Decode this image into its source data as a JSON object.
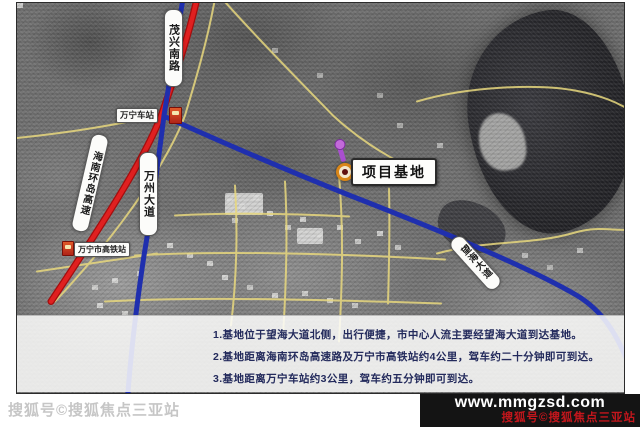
{
  "map": {
    "roads": {
      "maoxing_south_road": "茂兴南路",
      "hainan_ring_expressway": "海南环岛高速",
      "wanzhou_avenue": "万州大道",
      "wanghai_avenue": "望海大道"
    },
    "stations": {
      "wanning_railway_station": "万宁车站",
      "wanning_hsr_station": "万宁市高铁站"
    },
    "project_marker": {
      "label": "项目基地"
    },
    "info_box": {
      "line1": "1.基地位于望海大道北侧，出行便捷，市中心人流主要经望海大道到达基地。",
      "line2": "2.基地距离海南环岛高速路及万宁市高铁站约4公里，驾车约二十分钟即可到达。",
      "line3": "3.基地距离万宁车站约3公里，驾车约五分钟即可到达。"
    }
  },
  "watermarks": {
    "bottom_left": "搜狐号©搜狐焦点三亚站",
    "site_url": "www.mmgzsd.com",
    "site_caption": "搜狐号©搜狐焦点三亚站"
  },
  "colors": {
    "expressway_red": "#d81f1f",
    "avenue_blue": "#1f2fae",
    "minor_road_yellow": "#e8d87e",
    "marker_ring_orange": "#d98618",
    "info_text_navy": "#232a5c",
    "watermark_red": "#c3161c"
  }
}
